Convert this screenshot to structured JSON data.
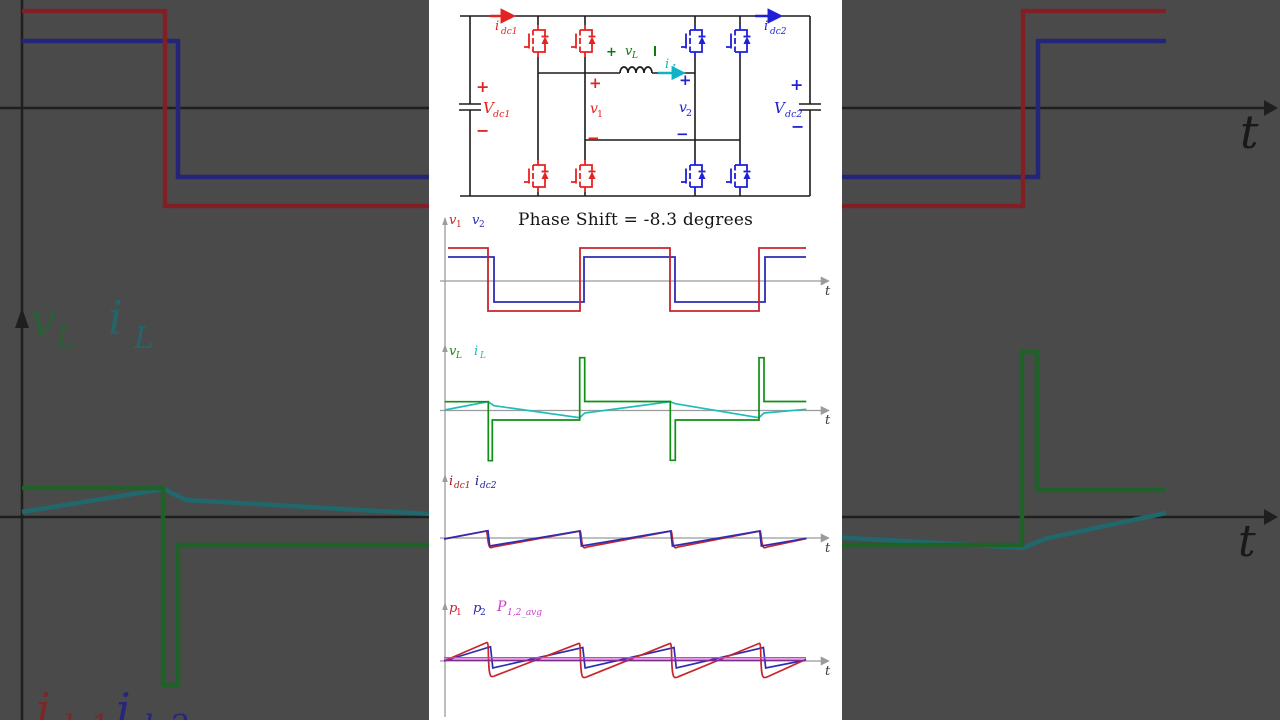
{
  "title": "Phase Shift = -8.3 degrees",
  "colors": {
    "panel_bg": "#ffffff",
    "dim_bg": "#4a4a4b",
    "circuit_red": "#e52222",
    "circuit_blue": "#1f1fd6",
    "circuit_green": "#0c7a0c",
    "circuit_teal": "#10b3c3",
    "wave_red": "#c8252b",
    "wave_blue": "#2d2db4",
    "wave_green": "#0f9014",
    "wave_teal": "#1fbcbc",
    "label_darkred": "#a01d1d",
    "label_navy": "#1d1d8f",
    "avg_magenta": "#cf3ed0",
    "avg_purple": "#7c2e8e",
    "axis_gray": "#9b9b9b",
    "bg_red": "#801f24",
    "bg_blue": "#232678",
    "bg_green": "#1f6128",
    "bg_teal": "#20686c"
  },
  "circuit": {
    "idc1": {
      "sym": "i",
      "sub": "dc1"
    },
    "idc2": {
      "sym": "i",
      "sub": "dc2"
    },
    "vdc1": {
      "sym": "V",
      "sub": "dc1",
      "plus": "+",
      "minus": "−"
    },
    "vdc2": {
      "sym": "V",
      "sub": "dc2",
      "plus": "+",
      "minus": "−"
    },
    "v1": {
      "sym": "v",
      "sub": "1",
      "plus": "+",
      "minus": "−"
    },
    "v2": {
      "sym": "v",
      "sub": "2",
      "plus": "+",
      "minus": "−"
    },
    "vl": {
      "sym": "v",
      "sub": "L",
      "plus": "+"
    },
    "il": {
      "sym": "i",
      "sub": "L"
    }
  },
  "plots": {
    "p1": {
      "l1": {
        "sym": "v",
        "sub": "1"
      },
      "l2": {
        "sym": "v",
        "sub": "2"
      },
      "t": "t"
    },
    "p2": {
      "l1": {
        "sym": "v",
        "sub": "L"
      },
      "l2": {
        "sym": "i",
        "sub": "L"
      },
      "t": "t"
    },
    "p3": {
      "l1": {
        "sym": "i",
        "sub": "dc1"
      },
      "l2": {
        "sym": "i",
        "sub": "dc2"
      },
      "t": "t"
    },
    "p4": {
      "l1": {
        "sym": "p",
        "sub": "1"
      },
      "l2": {
        "sym": "p",
        "sub": "2"
      },
      "l3": {
        "sym": "P",
        "sub": "1,2_avg"
      },
      "t": "t"
    }
  },
  "background": {
    "vl": {
      "sym": "v",
      "sub": "L"
    },
    "il": {
      "sym": "i",
      "sub": "L"
    },
    "idc1": {
      "sym": "i",
      "sub": "dc1"
    },
    "idc2": {
      "sym": "i",
      "sub": "dc2"
    },
    "t1": "t",
    "t2": "t"
  },
  "chart_data": [
    {
      "type": "line",
      "title": "v1, v2 full-bridge output voltages",
      "xlabel": "t",
      "phase_shift_deg": -8.3,
      "period_px": 181,
      "grid": false,
      "series": [
        {
          "name": "v1",
          "waveform": "square",
          "high": 1.0,
          "low": -0.91,
          "fall_x_px": [
            488,
            670
          ],
          "rise_x_px": [
            580,
            759
          ],
          "color": "#c8252b"
        },
        {
          "name": "v2",
          "waveform": "square",
          "high": 0.72,
          "low": -0.64,
          "fall_x_px": [
            494,
            675
          ],
          "rise_x_px": [
            584,
            765
          ],
          "color": "#2d2db4"
        }
      ]
    },
    {
      "type": "line",
      "title": "vL inductor voltage, iL inductor current",
      "xlabel": "t",
      "series": [
        {
          "name": "vL",
          "waveform": "stepped",
          "level_both_high": 0.26,
          "spike_down": -1.55,
          "level_both_low": -0.3,
          "spike_up": 1.6,
          "color": "#0f9014"
        },
        {
          "name": "iL",
          "waveform": "triangular",
          "peak": 0.27,
          "min": -0.22,
          "color": "#1fbcbc"
        }
      ]
    },
    {
      "type": "line",
      "title": "idc1, idc2 dc-side currents",
      "xlabel": "t",
      "series": [
        {
          "name": "idc1",
          "waveform": "sawtooth",
          "period": "T/2",
          "peak": 0.22,
          "min": -0.28,
          "drop": "curved",
          "color": "#c8252b"
        },
        {
          "name": "idc2",
          "waveform": "sawtooth",
          "period": "T/2",
          "peak": 0.22,
          "min": -0.24,
          "drop": "vertical",
          "color": "#2d2db4"
        }
      ]
    },
    {
      "type": "line",
      "title": "p1, p2 instantaneous powers with averages",
      "xlabel": "t",
      "series": [
        {
          "name": "p1",
          "waveform": "sawtooth",
          "period": "T/2",
          "peak": 0.57,
          "min": -0.48,
          "color": "#c8252b"
        },
        {
          "name": "p2",
          "waveform": "sawtooth",
          "period": "T/2",
          "peak": 0.43,
          "min": -0.21,
          "color": "#2d2db4"
        },
        {
          "name": "P_1_avg",
          "waveform": "constant",
          "value": 0.1,
          "color": "#cf3ed0"
        },
        {
          "name": "P_2_avg",
          "waveform": "constant",
          "value": 0.02,
          "color": "#7c2e8e"
        }
      ]
    }
  ]
}
